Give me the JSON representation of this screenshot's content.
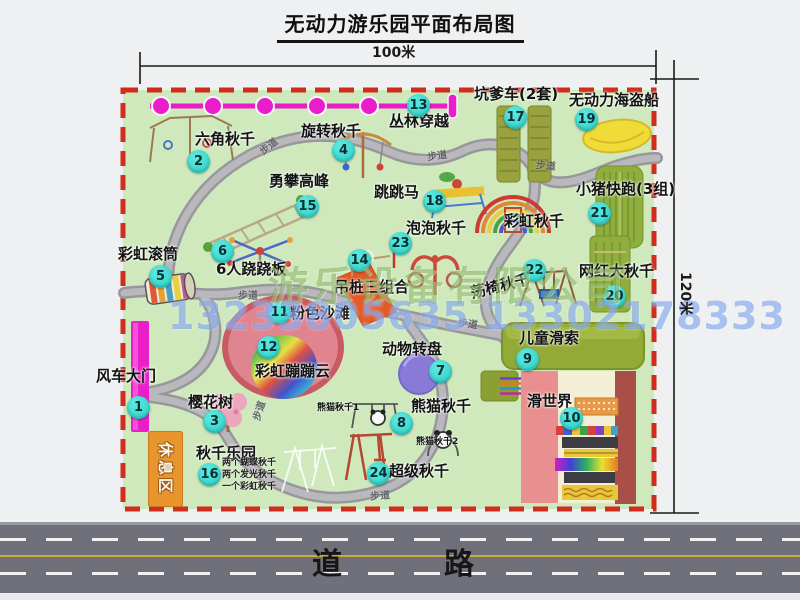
{
  "title": "无动力游乐园平面布局图",
  "dim_width": "100米",
  "dim_height": "120米",
  "road_label": "道　　路",
  "trail_label": "步道",
  "rest_area": "休息区",
  "rainbow_swing_label": "彩虹秋千",
  "watermark": {
    "company": "游乐设备有限公司",
    "phone": "13233805635 13302178333"
  },
  "attractions": [
    {
      "num": "1",
      "label": "风车大门"
    },
    {
      "num": "2",
      "label": "六角秋千"
    },
    {
      "num": "3",
      "label": "樱花树"
    },
    {
      "num": "4",
      "label": "旋转秋千"
    },
    {
      "num": "5",
      "label": "彩虹滚筒"
    },
    {
      "num": "6",
      "label": "6人跷跷板"
    },
    {
      "num": "7",
      "label": "动物转盘"
    },
    {
      "num": "8",
      "label": "熊猫秋千",
      "sub1": "熊猫秋千1",
      "sub2": "熊猫秋千2"
    },
    {
      "num": "9",
      "label": "儿童滑索"
    },
    {
      "num": "10",
      "label": "滑世界"
    },
    {
      "num": "11",
      "label": "粉色沙滩"
    },
    {
      "num": "12",
      "label": "彩虹蹦蹦云"
    },
    {
      "num": "13",
      "label": "丛林穿越"
    },
    {
      "num": "14",
      "label": "吊桩三组合"
    },
    {
      "num": "15",
      "label": "勇攀高峰"
    },
    {
      "num": "16",
      "label": "秋千乐园",
      "notes": [
        "两个蝴蝶秋千",
        "两个发光秋千",
        "一个彩虹秋千"
      ]
    },
    {
      "num": "17",
      "label": "坑爹车(2套)"
    },
    {
      "num": "18",
      "label": "跳跳马"
    },
    {
      "num": "19",
      "label": "无动力海盗船"
    },
    {
      "num": "20",
      "label": "网红大秋千"
    },
    {
      "num": "21",
      "label": "小猪快跑(3组)"
    },
    {
      "num": "22",
      "label": "荡椅秋千"
    },
    {
      "num": "23",
      "label": "泡泡秋千"
    },
    {
      "num": "24",
      "label": "超级秋千"
    }
  ],
  "colors": {
    "park_green": "#cfe9bd",
    "border_red": "#d22c1e",
    "badge_cyan": "#3ddcd4",
    "path_gray": "#a2a2a8",
    "road_gray": "#70707a",
    "gate_magenta": "#ea1fca",
    "rest_orange": "#e8952e"
  }
}
